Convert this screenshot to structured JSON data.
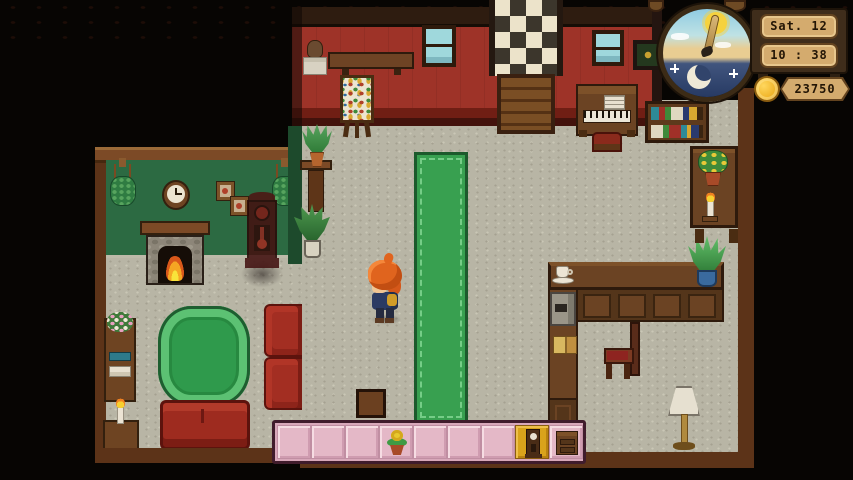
{
  "hud": {
    "date": "Sat. 12",
    "time": "10 : 38",
    "money": "23750",
    "coin_color": "#f0b429",
    "plaque_color": "#d4ab6e",
    "dial": {
      "phase": "day-and-night-wheel",
      "sun_color": "#f6d23e",
      "moon_color": "#efe9d6",
      "day_sky_color": "#a6d8e6",
      "night_sky_color": "#34476e"
    }
  },
  "hotbar": {
    "slot_count": 9,
    "selected_slot": 8,
    "slot_color": "#e4b8c7",
    "selected_color": "#d9a31b",
    "items": [
      {
        "slot": 4,
        "icon": "potted-flower-item"
      },
      {
        "slot": 8,
        "icon": "grandfather-clock-item"
      },
      {
        "slot": 9,
        "icon": "dresser-item"
      }
    ]
  },
  "scene": {
    "player": {
      "appearance": "orange-haired character facing left",
      "hair_color": "#e2621c"
    },
    "placement_preview": "grandfather-clock",
    "rooms": [
      {
        "name": "living-room",
        "wall_color": "#2c6a42"
      },
      {
        "name": "main-hall",
        "wall_color": "#9e3328"
      }
    ],
    "objects": [
      "hanging-plant",
      "wall-clock",
      "picture-frame",
      "fireplace",
      "flower-shelf",
      "candle-table",
      "round-rug",
      "couch",
      "armchair",
      "plant-stand",
      "potted-plant",
      "floor-plant",
      "wall-shelf",
      "hanging-note",
      "window",
      "easel-painting",
      "checkered-landing",
      "wooden-door",
      "piano",
      "piano-stool",
      "bookshelf",
      "framed-picture",
      "wall-sack",
      "counter",
      "coffee-cup",
      "coffee-machine",
      "books",
      "chair",
      "tall-shelf",
      "flower-pot",
      "candle",
      "floor-lamp",
      "runner-rug",
      "stool"
    ]
  }
}
